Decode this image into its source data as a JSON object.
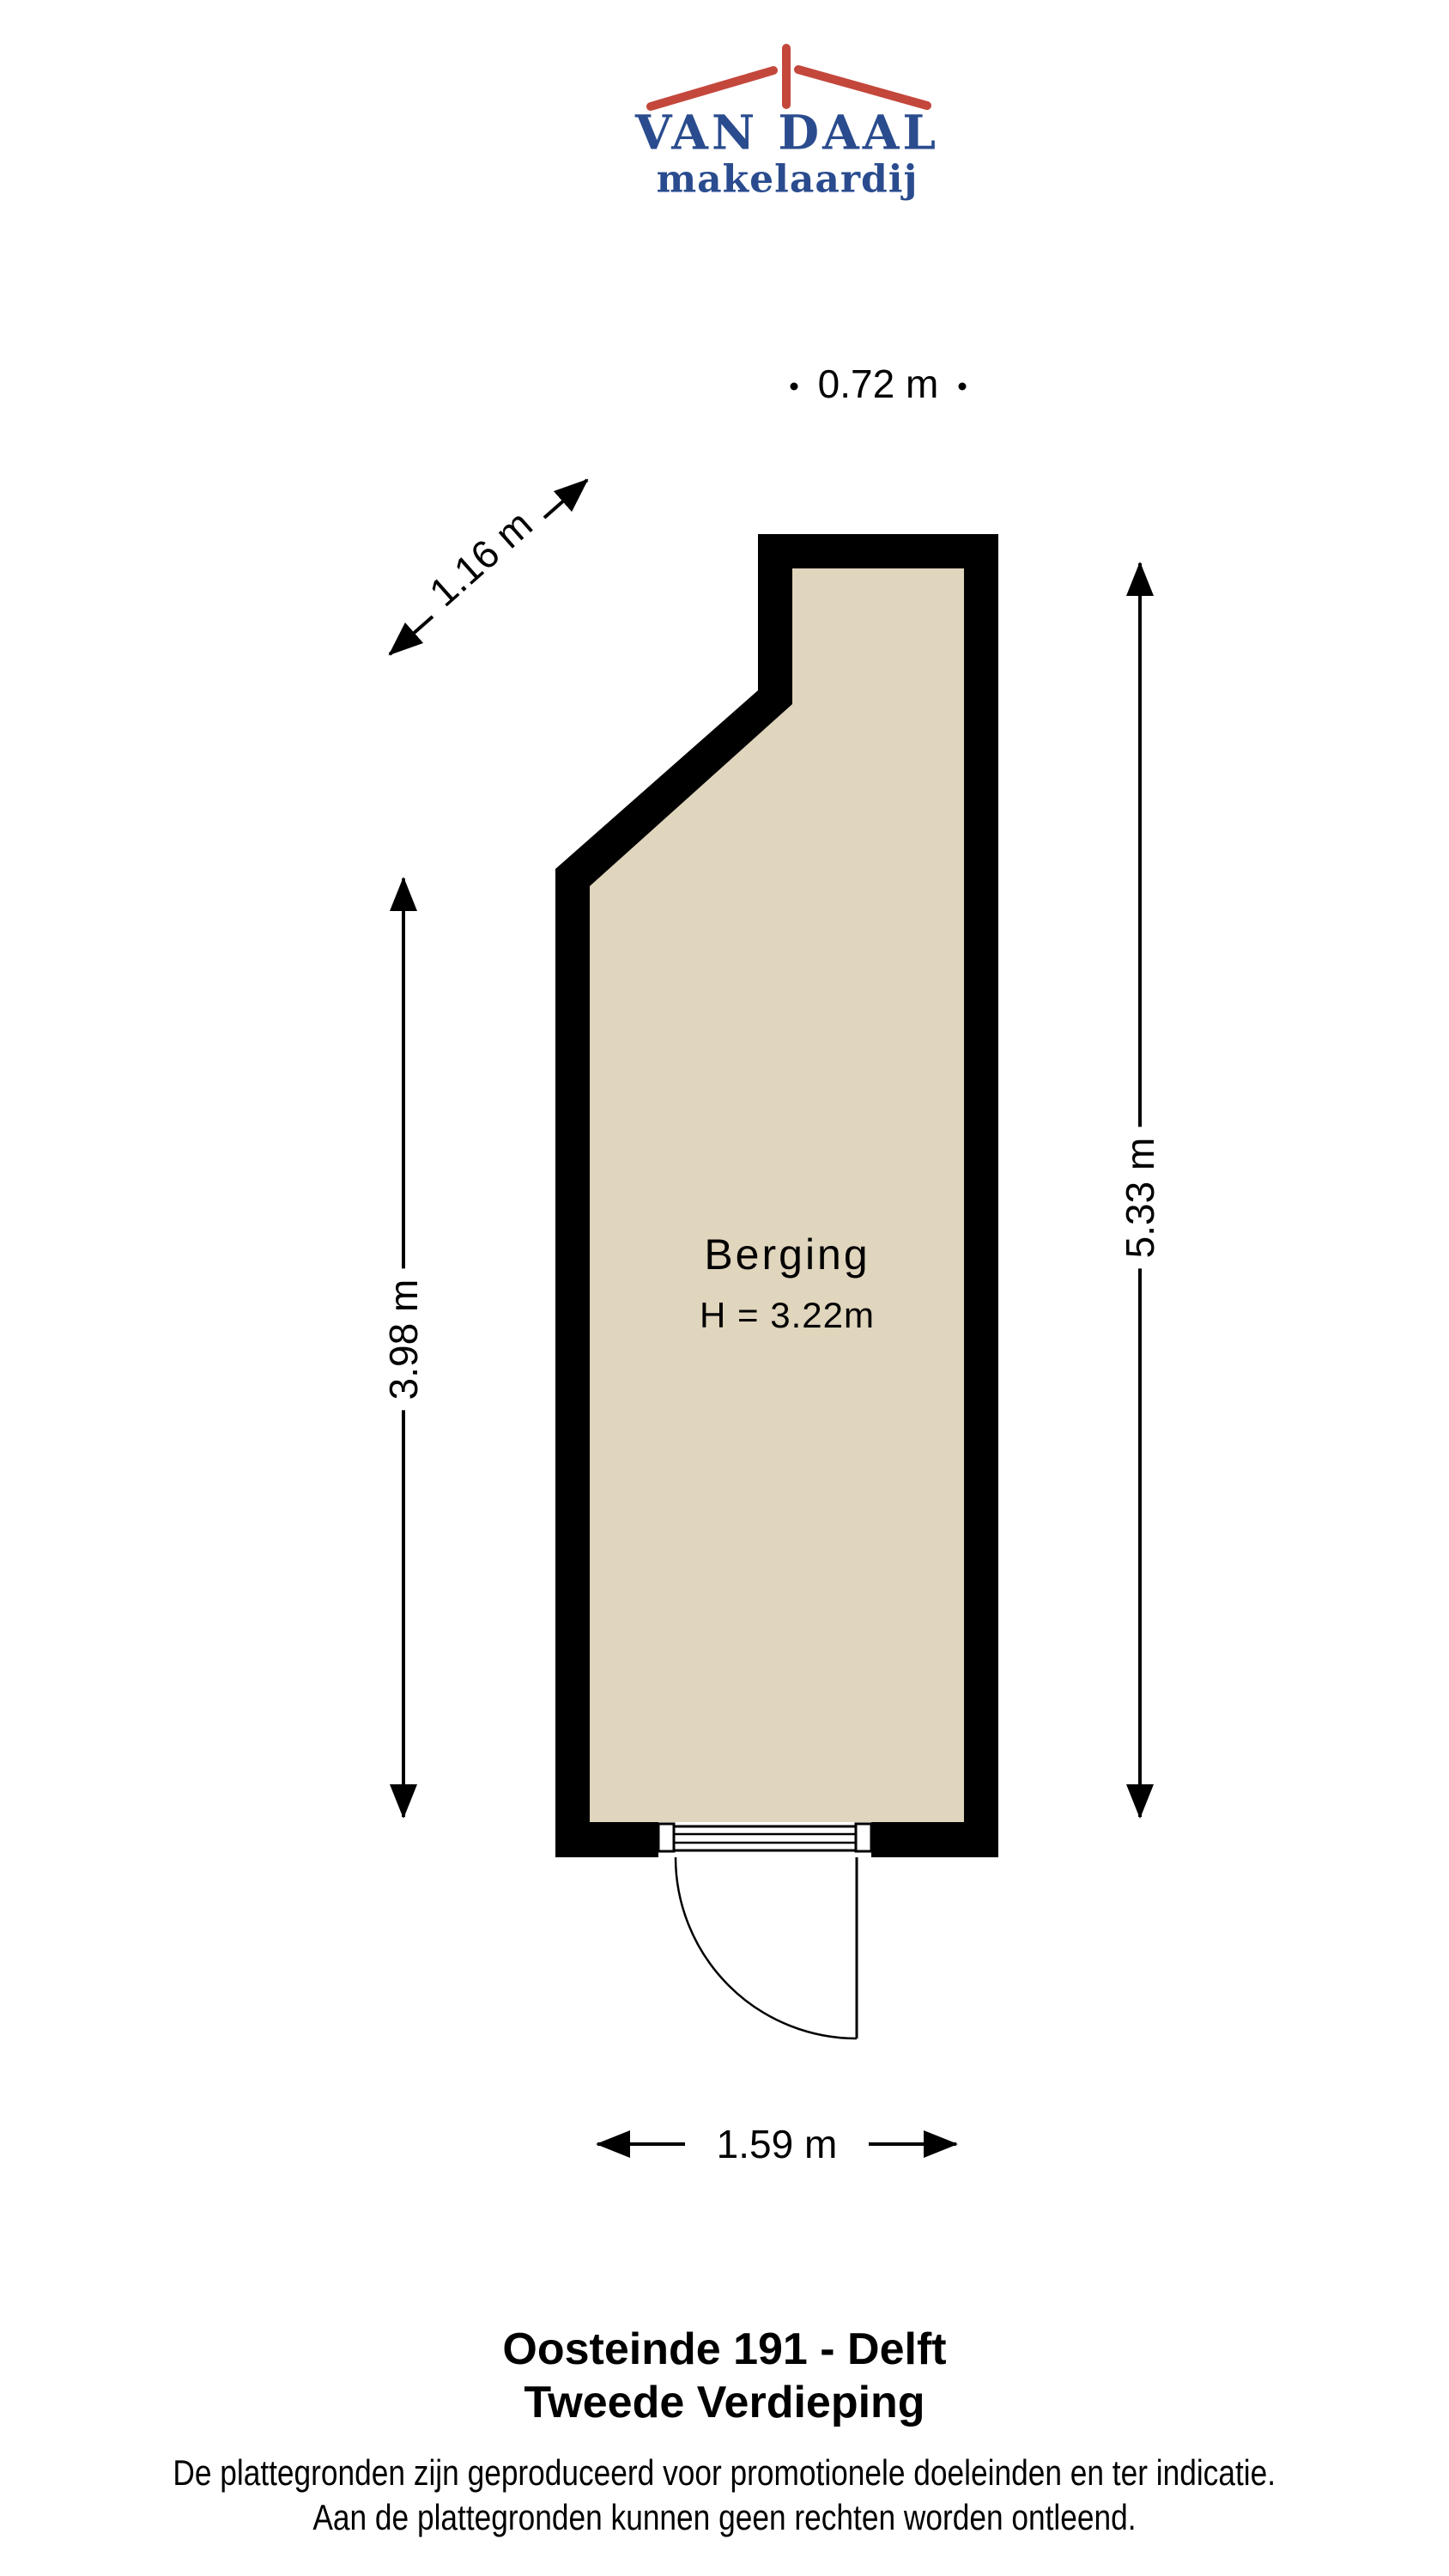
{
  "logo": {
    "name": "VAN DAAL",
    "subtitle": "makelaardij",
    "roof_color": "#c4473c",
    "text_color": "#2a4c8f"
  },
  "plan": {
    "room": {
      "label": "Berging",
      "height_label": "H = 3.22m"
    },
    "colors": {
      "floor": "#e0d5bd",
      "wall": "#000000"
    },
    "dimensions": {
      "top": "0.72 m",
      "diagonal": "1.16 m",
      "left": "3.98 m",
      "right": "5.33 m",
      "bottom": "1.59 m"
    }
  },
  "footer": {
    "title_line1": "Oosteinde 191 - Delft",
    "title_line2": "Tweede Verdieping",
    "disclaimer_line1": "De plattegronden zijn geproduceerd voor promotionele doeleinden en ter indicatie.",
    "disclaimer_line2": "Aan de plattegronden kunnen geen rechten worden ontleend."
  }
}
